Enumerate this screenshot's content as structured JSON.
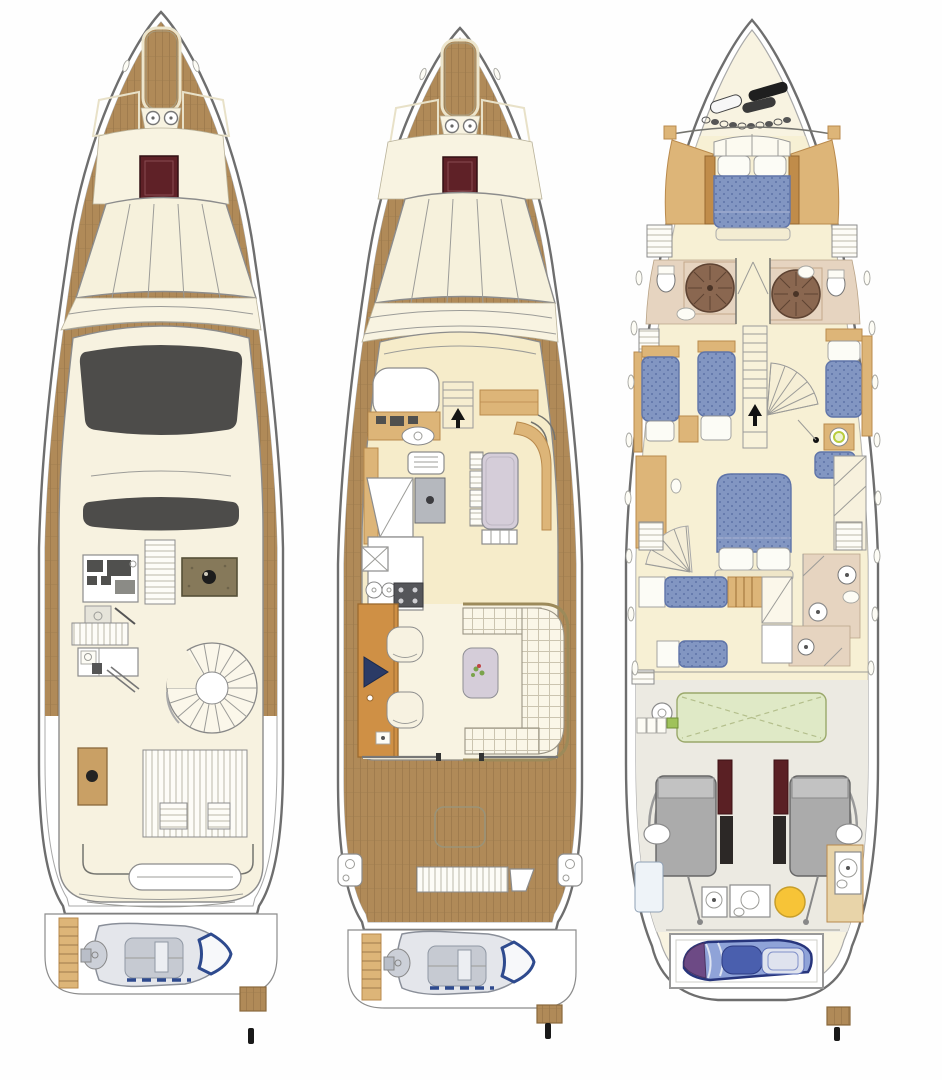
{
  "palette": {
    "bg": "#fefefe",
    "outline": "#6e6e6e",
    "outline2": "#a8a8a8",
    "teak": "#b08a58",
    "teakDark": "#8f6f45",
    "teakSeam": "#9c7a4e",
    "cream": "#f8f3e1",
    "topCream": "#f7f2e0",
    "floorYellow": "#f6ecca",
    "woodTan": "#ddb578",
    "woodDark": "#b98a4d",
    "woodOrange": "#cf9045",
    "hatchRed": "#5f2127",
    "sunroof": "#4d4c4a",
    "bedBlue": "#8296c2",
    "bedBlueDark": "#5f74a8",
    "lilac": "#d5cdd9",
    "sofaCream": "#faf6e8",
    "gridLine": "#cbc4b0",
    "bathFloor": "#e6d4c0",
    "showerBrown": "#8a6750",
    "tankGreen": "#dfe9c6",
    "heaterYellow": "#f7c437",
    "engineGray": "#ababab",
    "engineRed": "#5a2024",
    "navy": "#2e4a8e",
    "jetskiBlue": "#8fa3d8",
    "jetskiNavy": "#27357c",
    "jetskiPurple": "#6d4a85"
  },
  "decks": [
    {
      "id": "flybridge-deck",
      "features": [
        "anchor-locker",
        "windlass",
        "foredeck-hatch",
        "windshield",
        "open-sunroof",
        "hardtop",
        "helm-station",
        "companionway-stairs",
        "grill-unit",
        "bench-seat",
        "wet-bar",
        "boarding-ladder",
        "spiral-staircase",
        "side-table",
        "sun-loungers",
        "aft-bench",
        "swim-platform",
        "tender-with-outboard",
        "boarding-step",
        "flag-staff"
      ]
    },
    {
      "id": "main-deck",
      "features": [
        "anchor-locker",
        "windlass",
        "foredeck-hatch",
        "windshield",
        "helm-station",
        "companionway",
        "pilothouse-bench",
        "dinette-table",
        "galley-sink",
        "cooktop",
        "dishwasher",
        "stove",
        "refrigerator",
        "sideboard-tv",
        "armchairs",
        "coffee-table",
        "u-shaped-sofa",
        "aft-cockpit",
        "deck-hatch",
        "transom-steps",
        "swim-platform",
        "tender-with-outboard",
        "boarding-step",
        "flag-staff"
      ]
    },
    {
      "id": "lower-deck",
      "features": [
        "anchor-chain",
        "vip-cabin-double-bed",
        "ensuite-head-port",
        "ensuite-head-starboard",
        "shower",
        "staircase",
        "twin-cabin-port",
        "twin-cabin-starboard",
        "vanity-basin",
        "master-cabin-double-bed",
        "crew-bunks",
        "crew-locker",
        "aft-heads",
        "water-tank",
        "gauge",
        "batteries",
        "twin-engines",
        "mufflers",
        "water-heater",
        "garage",
        "jet-ski",
        "portholes",
        "boarding-step",
        "flag-staff"
      ]
    }
  ]
}
